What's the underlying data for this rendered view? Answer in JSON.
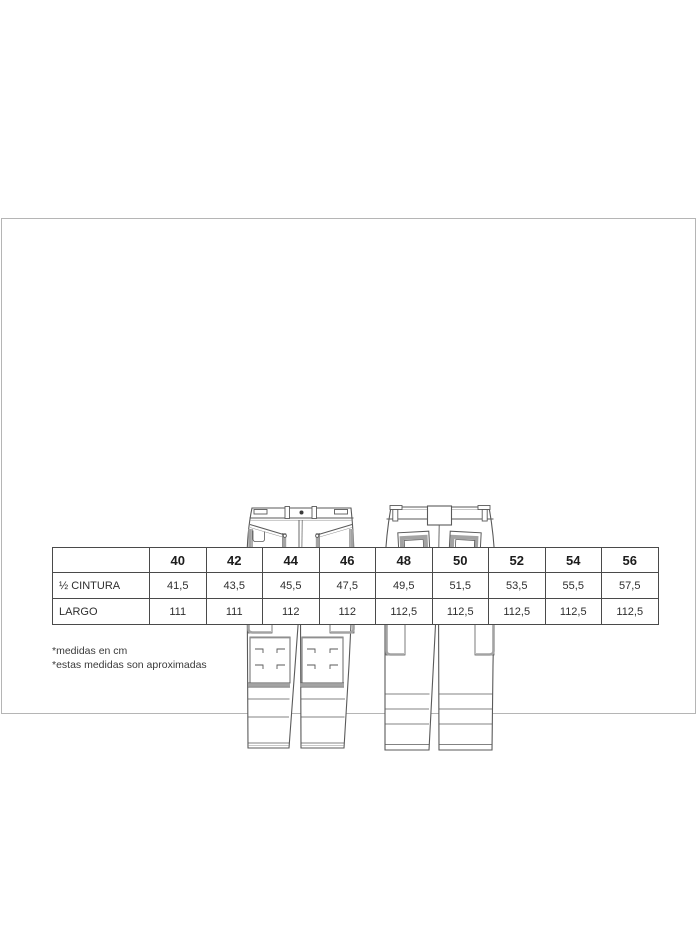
{
  "colors": {
    "thin_line": "#5a5a5a",
    "thick_band": "#a3a3a3",
    "table_border": "#4a4a4a",
    "page_border": "#b5b5b5"
  },
  "figures": {
    "front": "pants-front-technical-drawing",
    "back": "pants-back-technical-drawing"
  },
  "table": {
    "header": [
      "",
      "40",
      "42",
      "44",
      "46",
      "48",
      "50",
      "52",
      "54",
      "56"
    ],
    "rows": [
      {
        "label": "½ CINTURA",
        "values": [
          "41,5",
          "43,5",
          "45,5",
          "47,5",
          "49,5",
          "51,5",
          "53,5",
          "55,5",
          "57,5"
        ]
      },
      {
        "label": "LARGO",
        "values": [
          "111",
          "111",
          "112",
          "112",
          "112,5",
          "112,5",
          "112,5",
          "112,5",
          "112,5"
        ]
      }
    ]
  },
  "footnotes": [
    "*medidas en cm",
    "*estas medidas son aproximadas"
  ]
}
